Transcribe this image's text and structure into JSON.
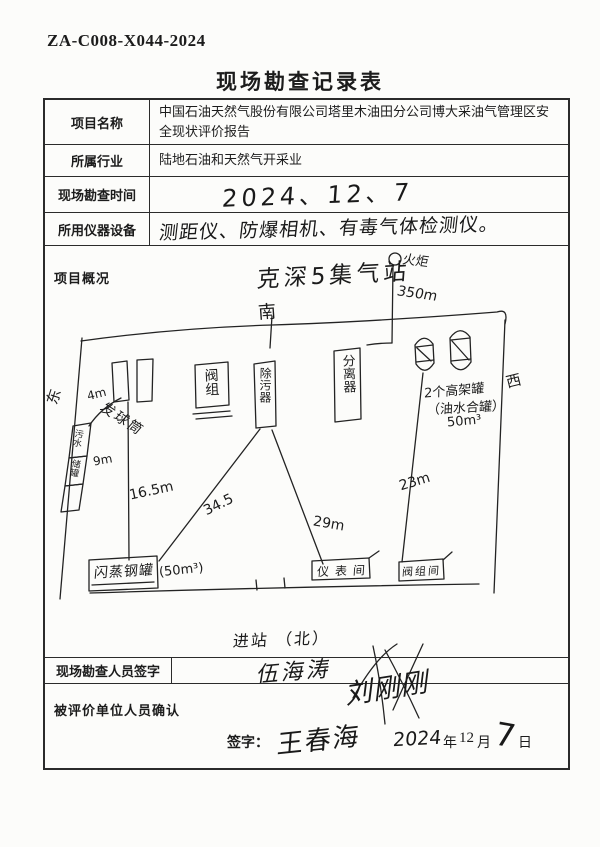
{
  "header": {
    "doc_number": "ZA-C008-X044-2024",
    "title": "现场勘查记录表"
  },
  "rows": {
    "project_name": {
      "label": "项目名称",
      "value": "中国石油天然气股份有限公司塔里木油田分公司博大采油气管理区安全现状评价报告"
    },
    "industry": {
      "label": "所属行业",
      "value": "陆地石油和天然气开采业"
    },
    "time": {
      "label": "现场勘查时间",
      "value": "2024、12、7"
    },
    "equipment": {
      "label": "所用仪器设备",
      "value": "测距仪、防爆相机、有毒气体检测仪。"
    },
    "overview": {
      "label": "项目概况"
    },
    "surveyor": {
      "label": "现场勘查人员签字",
      "sig1": "伍海涛",
      "sig2": "刘刚刚"
    },
    "confirm": {
      "label": "被评价单位人员确认",
      "sign_label": "签字：",
      "signature": "王春海",
      "year": "2024",
      "year_unit": "年",
      "month": "12",
      "month_unit": "月",
      "day": "7",
      "day_unit": "日"
    }
  },
  "sketch": {
    "station_title": "克深5集气站",
    "compass_top": "南",
    "compass_left": "东",
    "compass_right": "西",
    "entrance_note": "进站 （北）",
    "flare_label": "火炬",
    "flare_distance": "350m",
    "pig_launcher_label": "发球筒",
    "left_stack_top": "污水",
    "left_stack_bottom": "储罐",
    "valve_group_label": "阀组",
    "purifier_label": "除污器",
    "separator_label": "分离器",
    "tank_label_line1": "2个高架罐",
    "tank_label_line2": "（油水合罐）",
    "tank_label_line3": "50m³",
    "flash_tank_label": "闪蒸钢罐",
    "flash_tank_capacity": "(50m³)",
    "instrument_room_label": "仪表间",
    "valve_room_label": "阀组间",
    "dist_4m": "4m",
    "dist_9m": "9m",
    "dist_16_5m": "16.5m",
    "dist_34_5": "34.5",
    "dist_29m": "29m",
    "dist_23m": "23m"
  }
}
